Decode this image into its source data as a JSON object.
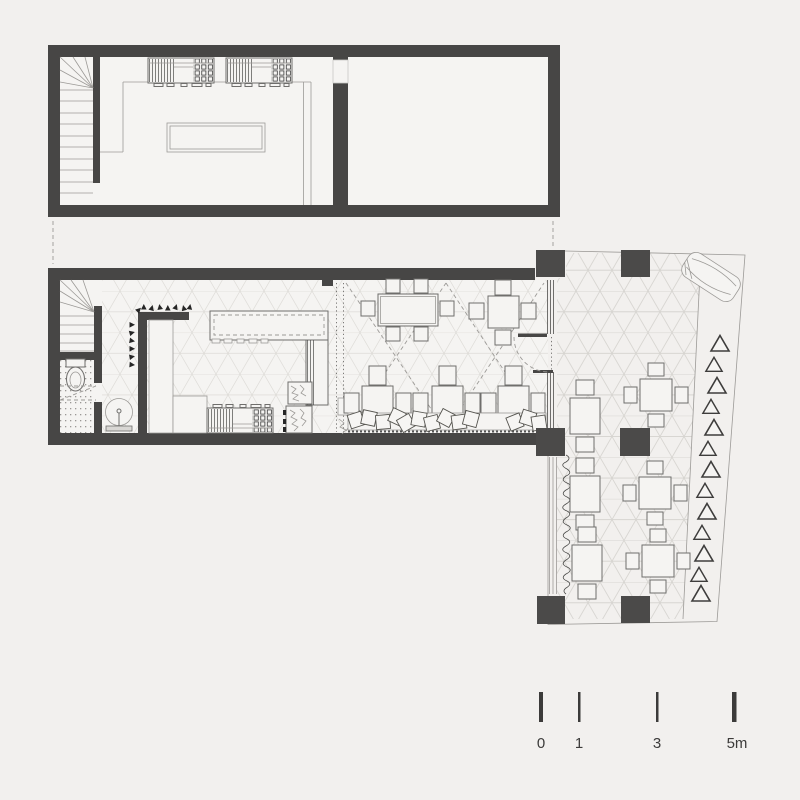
{
  "canvas": {
    "width": 800,
    "height": 800
  },
  "colors": {
    "background": "#f2f0ee",
    "floor": "#f5f4f2",
    "wall": "#474645",
    "column": "#4b4a49",
    "line": "#6f6e6c",
    "line2": "#9c9a97",
    "pattern": "#dedcd8",
    "pattern_outdoor": "#d7d5d1"
  },
  "scale_bar": {
    "labels": [
      "0",
      "1",
      "3",
      "5m"
    ]
  },
  "inventory": {
    "upper_floor": {
      "staircase": 1,
      "cooking_ranges": 2,
      "work_table": 1,
      "rooms": 2
    },
    "ground_floor": {
      "staircase": 1,
      "toilet": 1,
      "round_basin": 1,
      "coat_hooks": 14,
      "bar_counter": 1,
      "cooking_range": 1,
      "long_table_seats": 6,
      "square_table_seats": 4,
      "banquette_tables": 3,
      "bench_cushions": 13
    },
    "terrace": {
      "columns": 6,
      "four_seat_tables": 3,
      "two_seat_tables": 3,
      "trees": 13,
      "car": 1
    }
  }
}
